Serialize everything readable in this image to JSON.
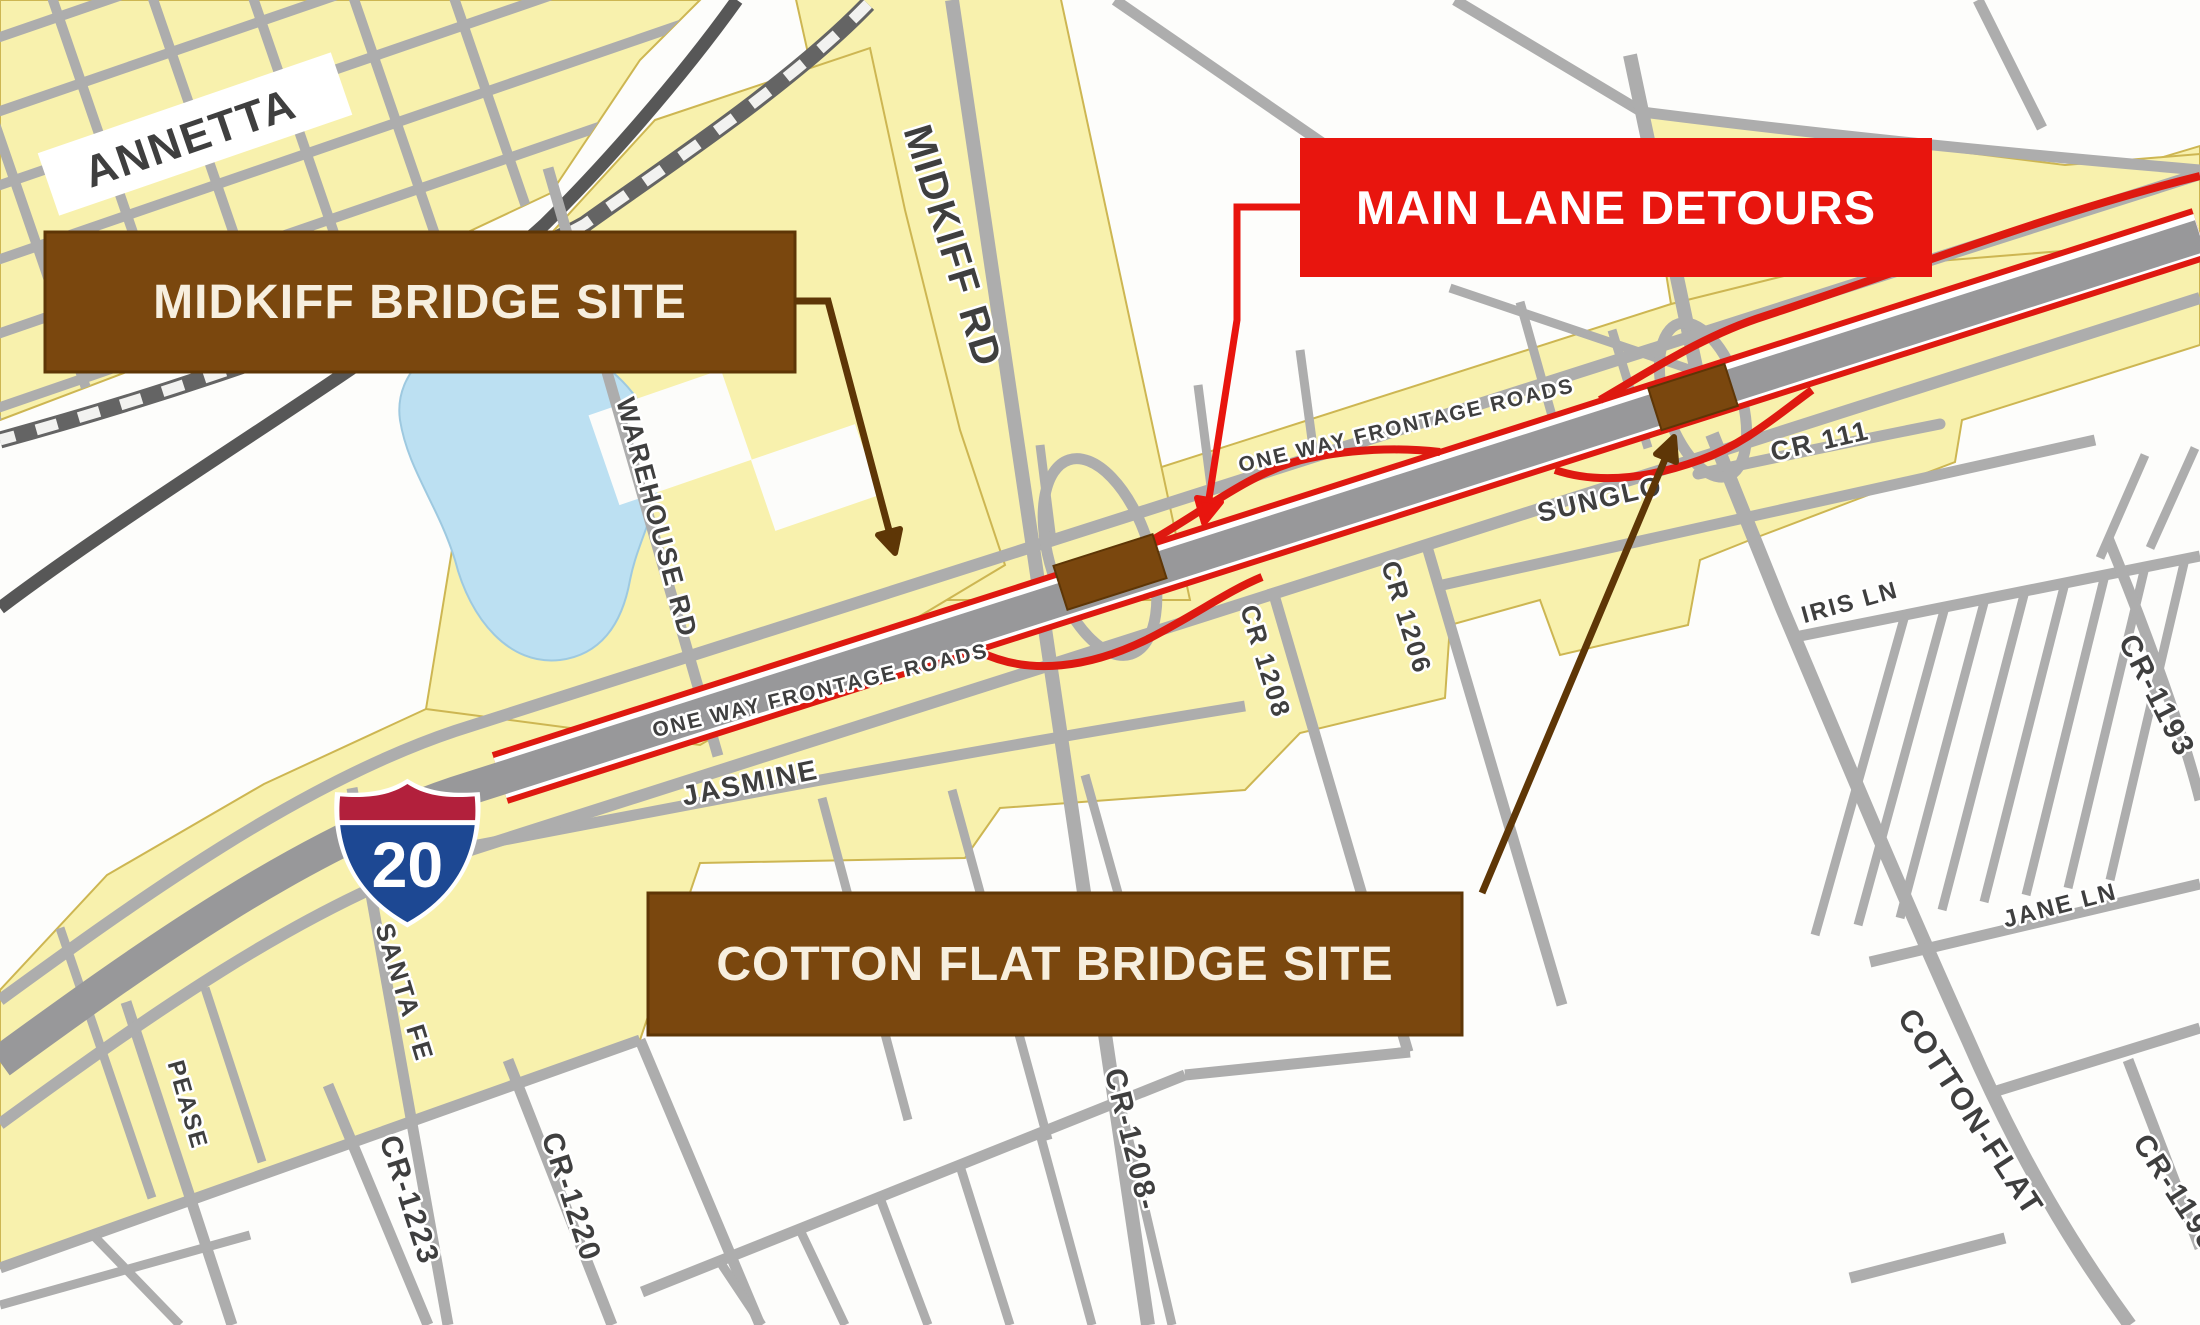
{
  "banners": {
    "midkiff": "MIDKIFF BRIDGE SITE",
    "main_lane": "MAIN LANE DETOURS",
    "cotton_flat": "COTTON FLAT BRIDGE SITE"
  },
  "shield": {
    "route": "20"
  },
  "labels": {
    "annetta": "ANNETTA",
    "midkiff_rd": "MIDKIFF RD",
    "warehouse_rd": "WAREHOUSE RD",
    "one_way_frontage_top": "ONE WAY FRONTAGE ROADS",
    "one_way_frontage_bottom": "ONE WAY FRONTAGE ROADS",
    "sunglo": "SUNGLO",
    "cr_111": "CR 111",
    "iris_ln": "IRIS LN",
    "jane_ln": "JANE LN",
    "cr_1193": "CR-1193",
    "cotton_flat_rd": "COTTON-FLAT",
    "cr_1198": "CR-1198",
    "jasmine": "JASMINE",
    "santa_fe": "SANTA FE",
    "pease": "PEASE",
    "cr_1223": "CR-1223",
    "cr_1220": "CR-1220",
    "cr_1208": "CR 1208",
    "cr_1206": "CR 1206",
    "cr_1208_south": "CR-1208-"
  },
  "colors": {
    "yellow-area": "#F8F1AD",
    "yellow-edge": "#CDB652",
    "road-gray": "#ADADAD",
    "main-lane-gray": "#98989A",
    "detour-red": "#DE1910",
    "banner-red": "#E8150E",
    "banner-brown": "#7A470E",
    "banner-brown-edge": "#5E3606",
    "banner-cream": "#F7EFDF",
    "work-zone-brown": "#7A470E",
    "arrow-brown": "#5E3606",
    "railroad-dark": "#646464",
    "pond-blue": "#BCE0F2",
    "label-color": "#3F3F3F",
    "shield-red": "#B2203C",
    "shield-blue": "#1D4893",
    "dark-road": "#575757"
  }
}
